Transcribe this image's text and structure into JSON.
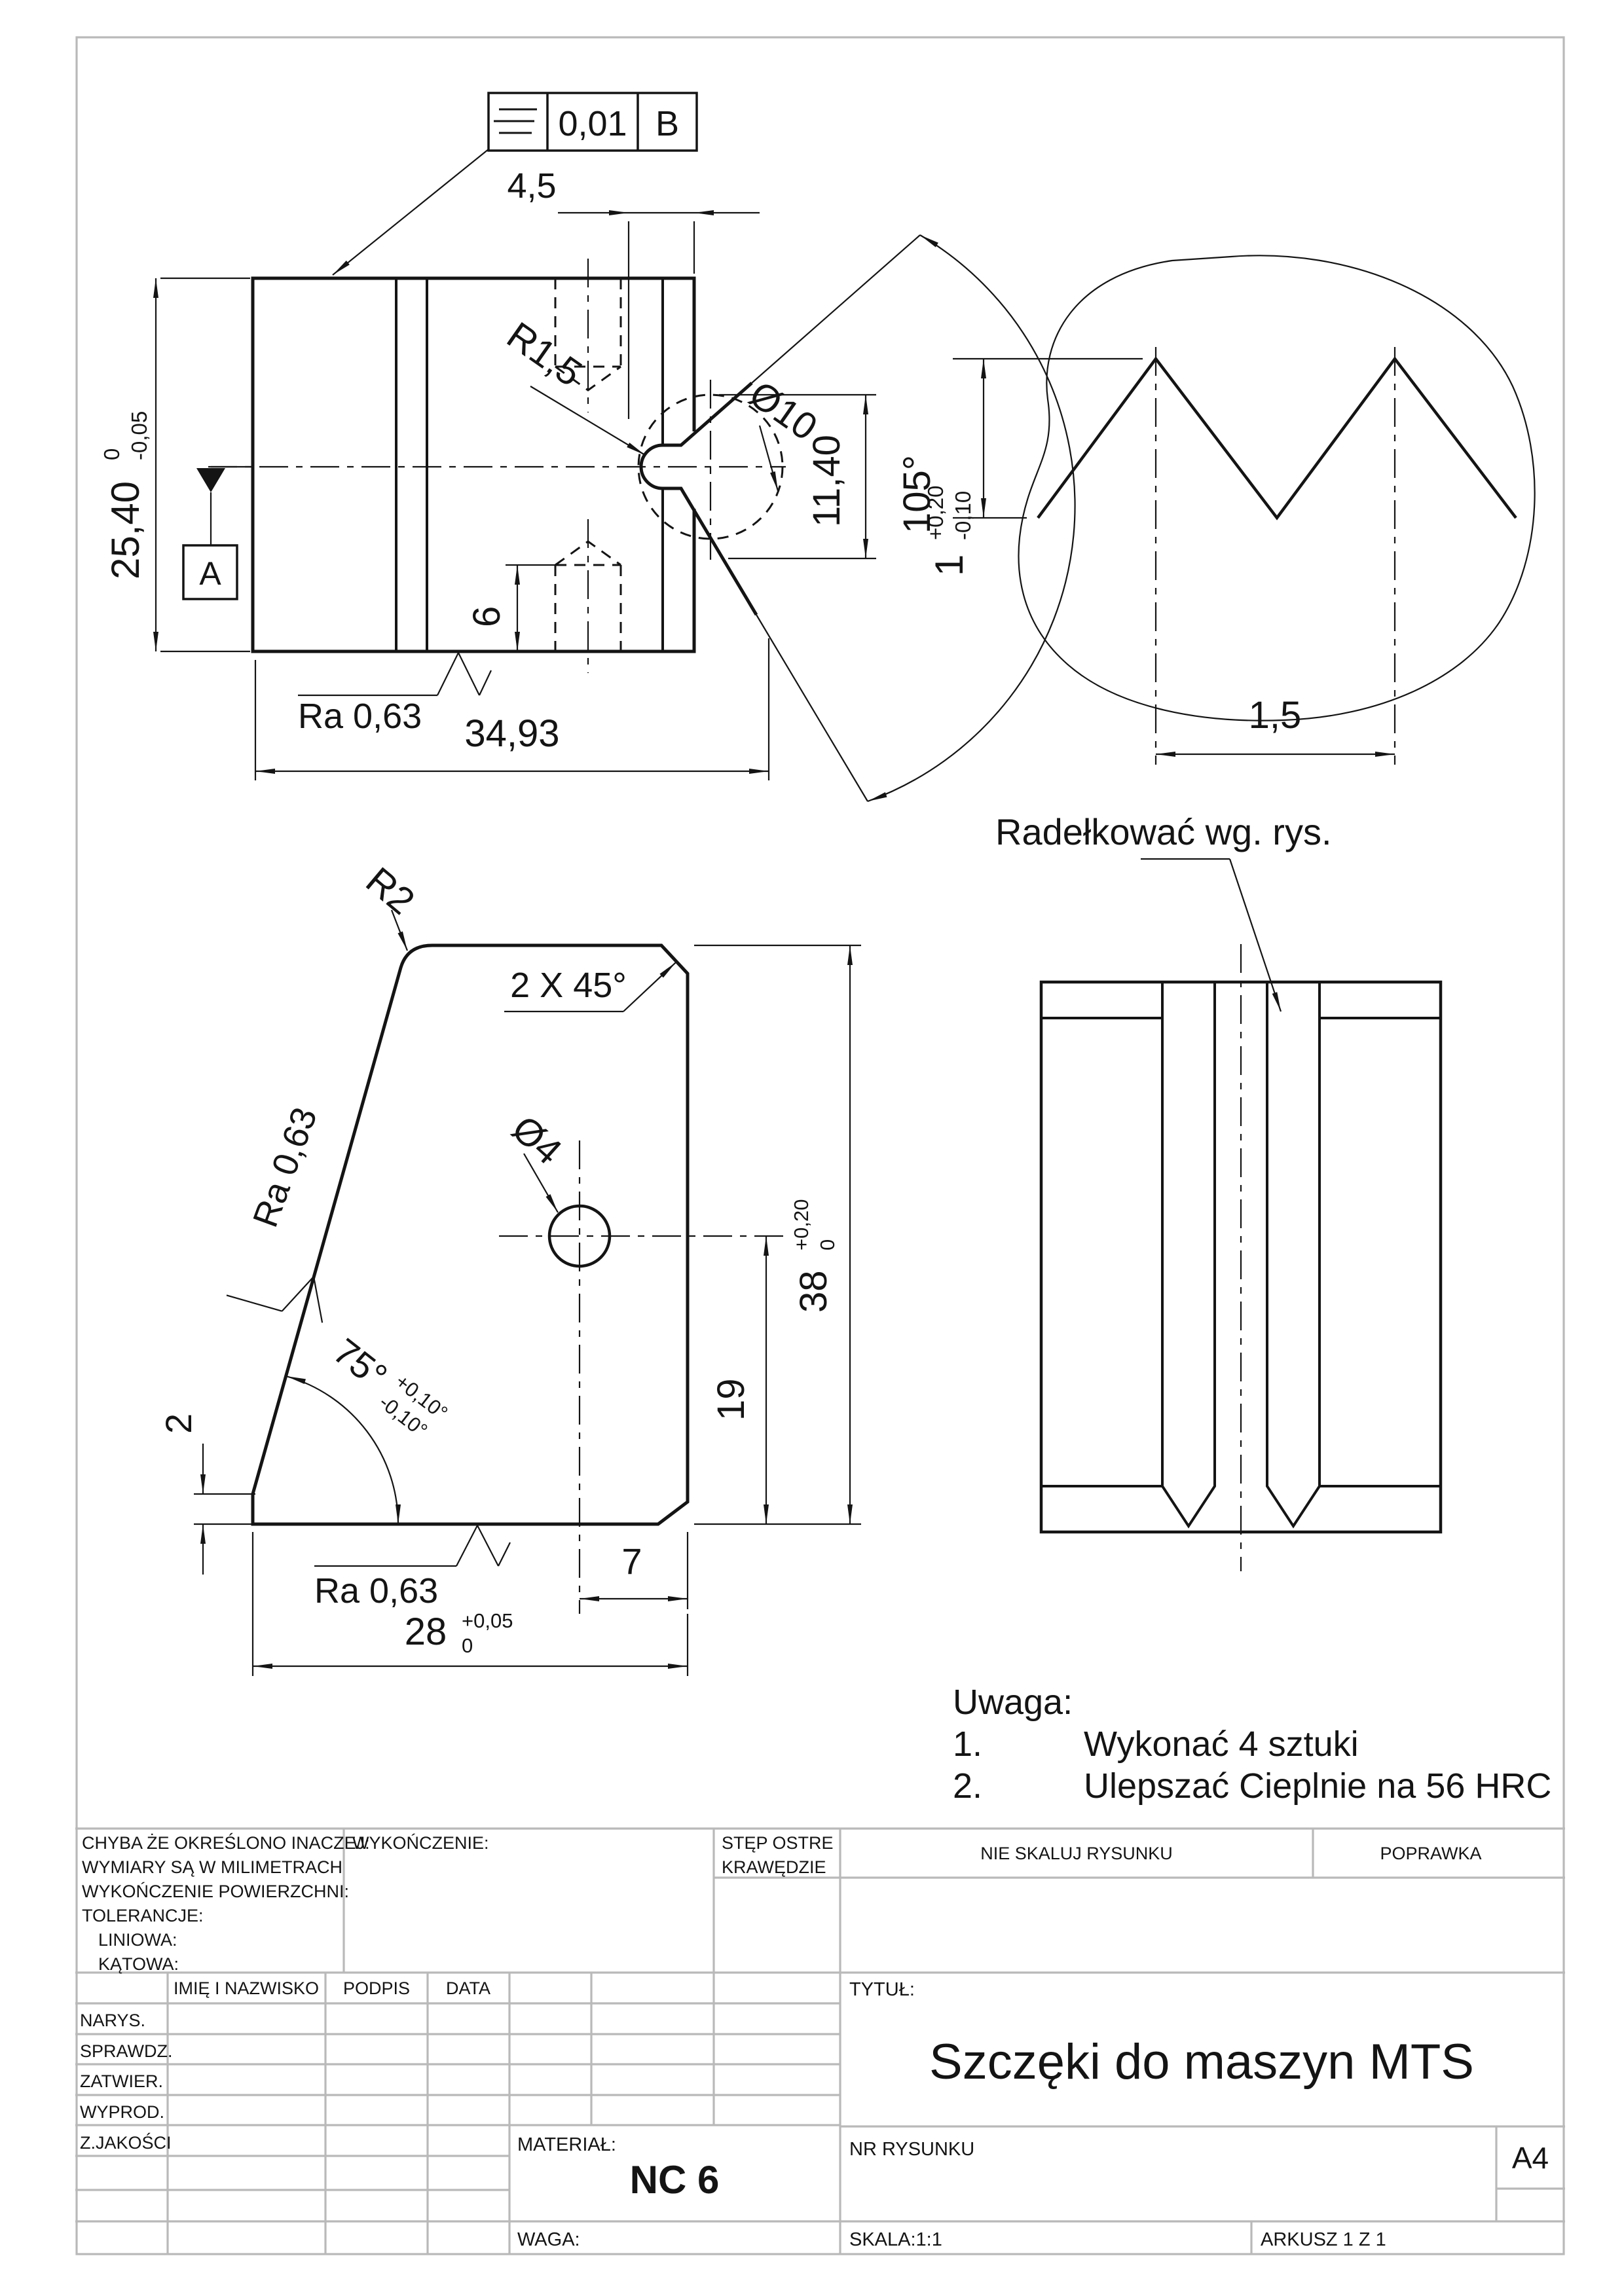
{
  "sheet": {
    "background": "#ffffff",
    "frame_color": "#b9b9b9",
    "ink_color": "#141414"
  },
  "gdt_frame": {
    "symbol": "symmetry-icon",
    "tolerance": "0,01",
    "datum": "B"
  },
  "front_view": {
    "dim_width_top": "4,5",
    "radius": "R1,5",
    "diameter": "Ø10",
    "dim_notch": "11,40",
    "angle": "105°",
    "height": "25,40",
    "height_tol_upper": "0",
    "height_tol_lower": "-0,05",
    "datum_label": "A",
    "hole_depth": "6",
    "roughness": "Ra 0,63",
    "width": "34,93"
  },
  "detail_view": {
    "depth": "1",
    "depth_tol_upper": "+0,20",
    "depth_tol_lower": "-0,10",
    "pitch": "1,5"
  },
  "side_view": {
    "knurl_note": "Radełkować wg. rys."
  },
  "profile_view": {
    "radius": "R2",
    "chamfer": "2 X 45°",
    "roughness_slant": "Ra 0,63",
    "hole_diameter": "Ø4",
    "height": "38",
    "height_tol_upper": "+0,20",
    "height_tol_lower": "0",
    "dim_hole_bottom": "19",
    "angle": "75°",
    "angle_tol_upper": "+0,10°",
    "angle_tol_lower": "-0,10°",
    "dim_step": "2",
    "dim_hole_edge": "7",
    "width": "28",
    "width_tol_upper": "+0,05",
    "width_tol_lower": "0",
    "roughness_bottom": "Ra 0,63"
  },
  "notes": {
    "heading": "Uwaga:",
    "item1_num": "1.",
    "item1_text": "Wykonać 4 sztuki",
    "item2_num": "2.",
    "item2_text": "Ulepszać Cieplnie na 56 HRC"
  },
  "title_block": {
    "general_notes": [
      "CHYBA ŻE OKREŚLONO INACZEJ:",
      "WYMIARY SĄ W MILIMETRACH",
      "WYKOŃCZENIE POWIERZCHNI:",
      "TOLERANCJE:",
      "LINIOWA:",
      "KĄTOWA:"
    ],
    "finish_label": "WYKOŃCZENIE:",
    "edges_label_line1": "STĘP OSTRE",
    "edges_label_line2": "KRAWĘDZIE",
    "no_scale": "NIE SKALUJ RYSUNKU",
    "revision": "POPRAWKA",
    "col_name": "IMIĘ I NAZWISKO",
    "col_signature": "PODPIS",
    "col_date": "DATA",
    "rows": [
      "NARYS.",
      "SPRAWDZ.",
      "ZATWIER.",
      "WYPROD.",
      "Z.JAKOŚCI"
    ],
    "material_label": "MATERIAŁ:",
    "material_value": "NC 6",
    "weight_label": "WAGA:",
    "title_label": "TYTUŁ:",
    "title": "Szczęki do maszyn MTS",
    "drawing_no_label": "NR RYSUNKU",
    "format": "A4",
    "scale": "SKALA:1:1",
    "sheet": "ARKUSZ 1 Z 1"
  }
}
